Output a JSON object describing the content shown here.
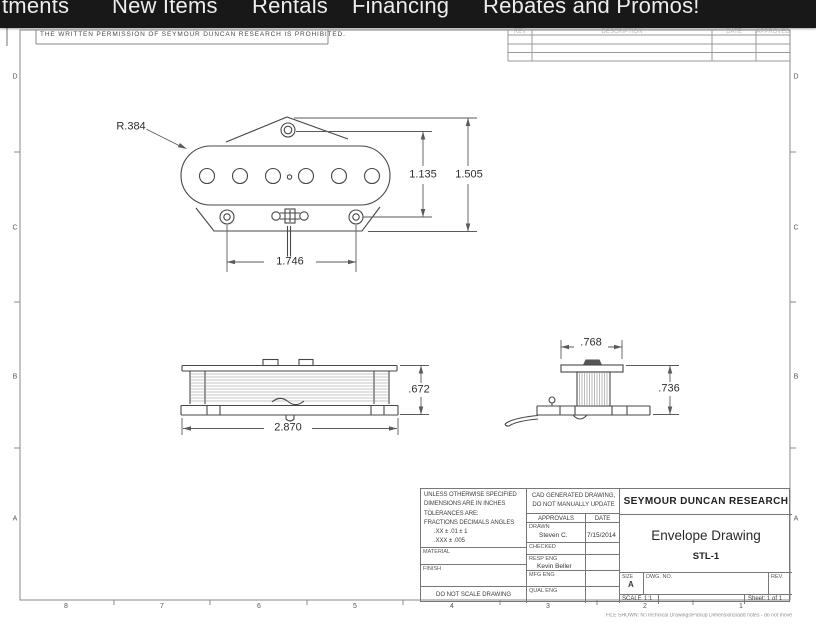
{
  "nav": {
    "items": [
      "tments",
      "New Items",
      "Rentals",
      "Financing",
      "Rebates and Promos!"
    ]
  },
  "sheet": {
    "proprietary_notice": "THE WRITTEN PERMISSION OF SEYMOUR DUNCAN RESEARCH IS PROHIBITED.",
    "revision_table_headers": [
      "REV",
      "DESCRIPTION",
      "DATE",
      "APPROVED"
    ],
    "zone_letters": [
      "D",
      "C",
      "B",
      "A"
    ],
    "zone_numbers": [
      "8",
      "7",
      "6",
      "5",
      "4",
      "3",
      "2",
      "1"
    ],
    "file_note": "FILE SHOWN: N:\\Technical Drawings\\Pickup Dimensions\\add notes - do not move"
  },
  "views": {
    "top_view": {
      "radius": "R.384",
      "inner_height": "1.135",
      "overall_height": "1.505",
      "screw_spacing": "1.746"
    },
    "front_view": {
      "height": ".672",
      "width": "2.870"
    },
    "end_view": {
      "top_width": ".768",
      "height": ".736"
    }
  },
  "title_block": {
    "tolerance_lines": [
      "UNLESS OTHERWISE SPECIFIED",
      "DIMENSIONS ARE IN INCHES",
      "TOLERANCES ARE:",
      "FRACTIONS  DECIMALS  ANGLES",
      ".XX ±  .01      ± 1",
      ".XXX ±  .005"
    ],
    "material_label": "MATERIAL",
    "finish_label": "FINISH",
    "no_scale": "DO NOT SCALE DRAWING",
    "cad_note_line1": "CAD GENERATED DRAWING,",
    "cad_note_line2": "DO NOT MANUALLY UPDATE",
    "approvals_header": "APPROVALS",
    "date_header": "DATE",
    "drawn_label": "DRAWN",
    "drawn_name": "Steven C.",
    "drawn_date": "7/15/2014",
    "checked_label": "CHECKED",
    "resp_eng_label": "RESP ENG",
    "resp_eng_name": "Kevin Beller",
    "mfg_eng_label": "MFG ENG",
    "qual_eng_label": "QUAL ENG",
    "company": "SEYMOUR DUNCAN RESEARCH",
    "drawing_title": "Envelope Drawing",
    "part_number": "STL-1",
    "size_label": "SIZE",
    "size_value": "A",
    "dwg_no_label": "DWG. NO.",
    "rev_label": "REV.",
    "scale_label": "SCALE",
    "scale_value": "1:1",
    "sheet_label": "Sheet: 1 of 1"
  }
}
